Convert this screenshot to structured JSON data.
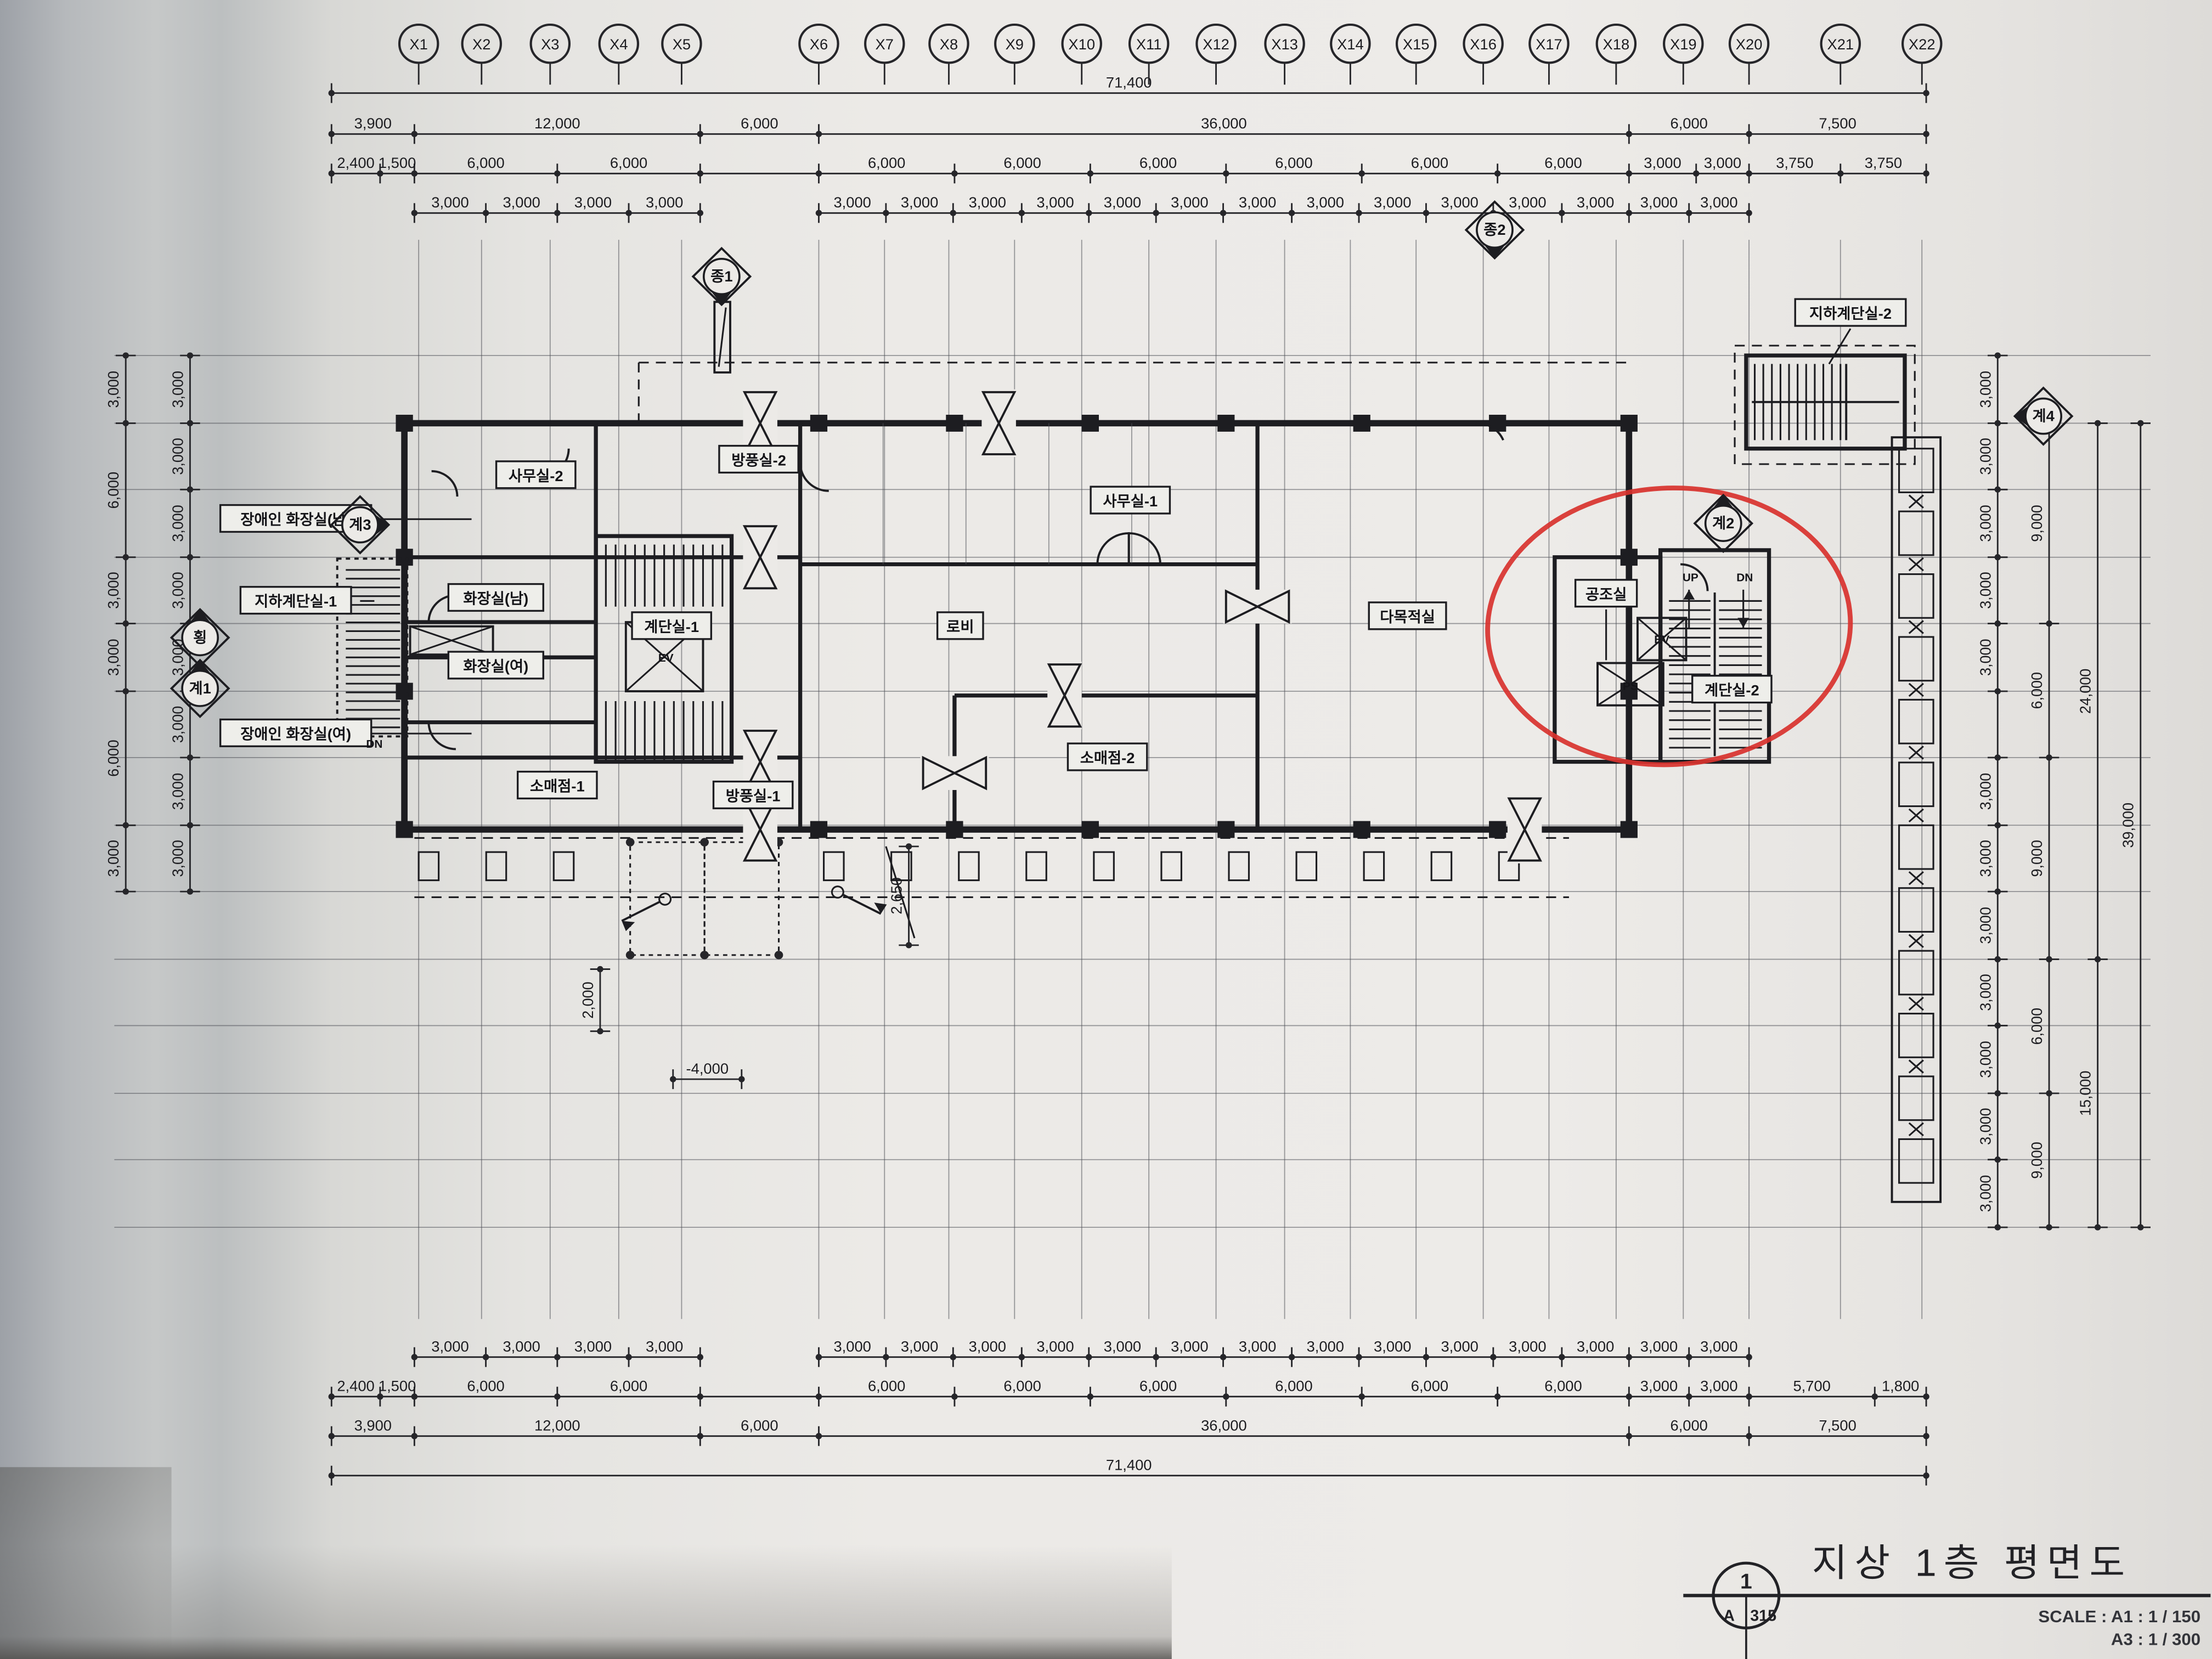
{
  "colors": {
    "paper": "#eae9e6",
    "ink": "#222226",
    "red": "#d8322e"
  },
  "grid": {
    "x_bubbles": [
      "X1",
      "X2",
      "X3",
      "X4",
      "X5",
      "X6",
      "X7",
      "X8",
      "X9",
      "X10",
      "X11",
      "X12",
      "X13",
      "X14",
      "X15",
      "X16",
      "X17",
      "X18",
      "X19",
      "X20",
      "X21",
      "X22"
    ]
  },
  "dims": {
    "top1": [
      "71,400"
    ],
    "top2": [
      "3,900",
      "12,000",
      "6,000",
      "36,000",
      "6,000",
      "7,500"
    ],
    "top3": [
      "2,400",
      "1,500",
      "6,000",
      "6,000",
      "",
      "6,000",
      "6,000",
      "6,000",
      "6,000",
      "6,000",
      "6,000",
      "3,000",
      "3,000",
      "3,750",
      "3,750"
    ],
    "top4a": [
      "3,000",
      "3,000",
      "3,000",
      "3,000"
    ],
    "top4b": [
      "3,000",
      "3,000",
      "3,000",
      "3,000",
      "3,000",
      "3,000",
      "3,000",
      "3,000",
      "3,000",
      "3,000",
      "3,000",
      "3,000",
      "3,000",
      "3,000"
    ],
    "bot1a": [
      "3,000",
      "3,000",
      "3,000",
      "3,000"
    ],
    "bot1b": [
      "3,000",
      "3,000",
      "3,000",
      "3,000",
      "3,000",
      "3,000",
      "3,000",
      "3,000",
      "3,000",
      "3,000",
      "3,000",
      "3,000",
      "3,000",
      "3,000"
    ],
    "bot2": [
      "2,400",
      "1,500",
      "6,000",
      "6,000",
      "",
      "6,000",
      "6,000",
      "6,000",
      "6,000",
      "6,000",
      "6,000",
      "3,000",
      "3,000",
      "5,700",
      "1,800"
    ],
    "bot3": [
      "3,900",
      "12,000",
      "6,000",
      "36,000",
      "6,000",
      "7,500"
    ],
    "bot4": [
      "71,400"
    ],
    "left_inner": [
      "3,000",
      "3,000",
      "3,000",
      "3,000",
      "3,000",
      "3,000",
      "3,000",
      "3,000"
    ],
    "left_outer": [
      "3,000",
      "6,000",
      "3,000",
      "3,000",
      "6,000",
      "3,000"
    ],
    "right1": [
      "3,000",
      "3,000",
      "3,000",
      "3,000",
      "3,000",
      "",
      "3,000",
      "3,000",
      "3,000",
      "3,000",
      "3,000",
      "3,000",
      "3,000"
    ],
    "right2": [
      "9,000",
      "6,000",
      "9,000",
      "6,000",
      "9,000"
    ],
    "right3": [
      "24,000",
      "15,000"
    ],
    "right4": [
      "39,000"
    ],
    "c_4000": [
      "-4,000"
    ],
    "c_2000": [
      "2,000"
    ],
    "c_2650": [
      "2,650"
    ]
  },
  "rooms": [
    {
      "id": "samusil2",
      "label": "사무실-2"
    },
    {
      "id": "bangpung2",
      "label": "방풍실-2"
    },
    {
      "id": "samusil1",
      "label": "사무실-1"
    },
    {
      "id": "lobby",
      "label": "로비"
    },
    {
      "id": "damokjeok",
      "label": "다목적실"
    },
    {
      "id": "hwajang_nam",
      "label": "화장실(남)"
    },
    {
      "id": "hwajang_yeo",
      "label": "화장실(여)"
    },
    {
      "id": "gyedansil1",
      "label": "계단실-1"
    },
    {
      "id": "somae1",
      "label": "소매점-1"
    },
    {
      "id": "bangpung1",
      "label": "방풍실-1"
    },
    {
      "id": "somae2",
      "label": "소매점-2"
    },
    {
      "id": "gongjosil",
      "label": "공조실"
    },
    {
      "id": "gyedansil2",
      "label": "계단실-2"
    },
    {
      "id": "jiha_gyedan1",
      "label": "지하계단실-1"
    },
    {
      "id": "jangae_nam",
      "label": "장애인 화장실(남)"
    },
    {
      "id": "jangae_yeo",
      "label": "장애인 화장실(여)"
    },
    {
      "id": "jiha_gyedan2",
      "label": "지하계단실-2"
    }
  ],
  "markers": [
    {
      "id": "jong1",
      "label": "종1"
    },
    {
      "id": "jong2",
      "label": "종2"
    },
    {
      "id": "gye1",
      "label": "계1"
    },
    {
      "id": "gye2",
      "label": "계2"
    },
    {
      "id": "gye3",
      "label": "계3"
    },
    {
      "id": "gye4",
      "label": "계4"
    },
    {
      "id": "hoeng",
      "label": "횡"
    }
  ],
  "small_texts": [
    {
      "id": "up1",
      "label": "UP"
    },
    {
      "id": "dn1",
      "label": "DN"
    },
    {
      "id": "ev2",
      "label": "EV"
    },
    {
      "id": "ps2",
      "label": "PS"
    },
    {
      "id": "dn_west",
      "label": "DN"
    },
    {
      "id": "ev1",
      "label": "EV"
    }
  ],
  "title_block": {
    "sheet_no": "1",
    "sheet_row": "A",
    "sheet_num": "315",
    "title": "지상 1층 평면도",
    "scale_line1": "SCALE : A1 : 1 / 150",
    "scale_line2": "A3 : 1 / 300"
  }
}
